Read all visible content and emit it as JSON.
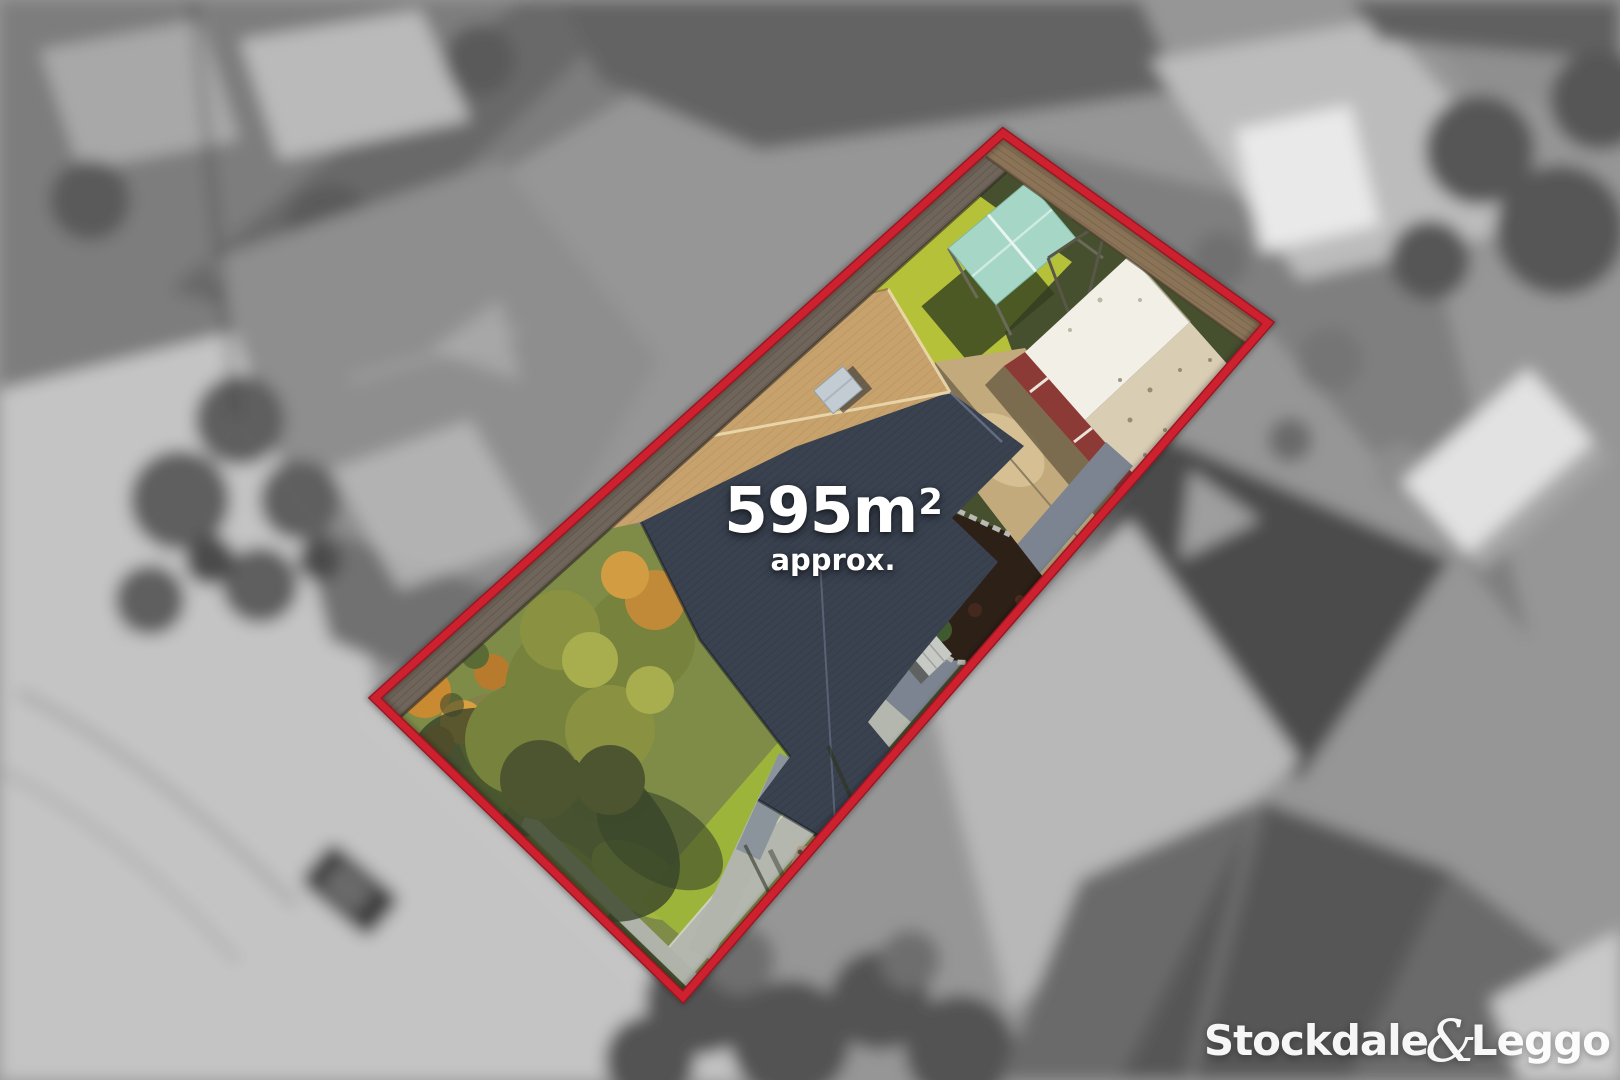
{
  "overlay": {
    "area": {
      "number": "595",
      "unit": "m",
      "superscript": "2",
      "qualifier": "approx."
    }
  },
  "brand": {
    "word1": "Stockdale",
    "ampersand": "&",
    "word2": "Leggo"
  },
  "colors": {
    "boundary_red": "#ce2130",
    "overlay_text": "#ffffff",
    "sunlit_lawn": "#b5c138",
    "shaded_lawn": "#46502f",
    "roof_sunlit_tan": "#c7a26d",
    "roof_shaded_slate": "#3a4250",
    "garage_wall_red": "#8c3a36"
  }
}
